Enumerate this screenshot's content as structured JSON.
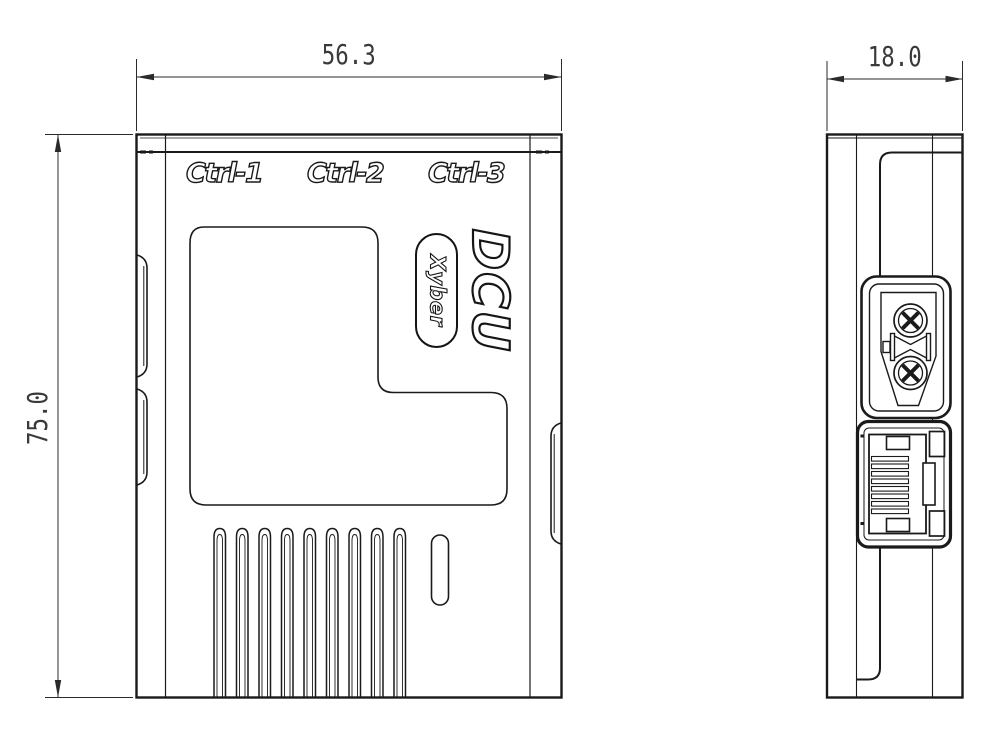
{
  "page": {
    "background_color": "#ffffff",
    "line_color": "#1a1a1a"
  },
  "front_view": {
    "port_labels": [
      "Ctrl-1",
      "Ctrl-2",
      "Ctrl-3"
    ],
    "product_name": "DCU",
    "brand": "Xyber",
    "dimensions": {
      "width": "56.3",
      "height": "75.0"
    }
  },
  "side_view": {
    "dimensions": {
      "depth": "18.0"
    },
    "connectors": [
      "xt30-power-connector",
      "rj45-ethernet-port"
    ]
  },
  "details": {
    "vent_slot_count": 9,
    "rj45_pin_count": 8,
    "power_pin_count": 2
  }
}
